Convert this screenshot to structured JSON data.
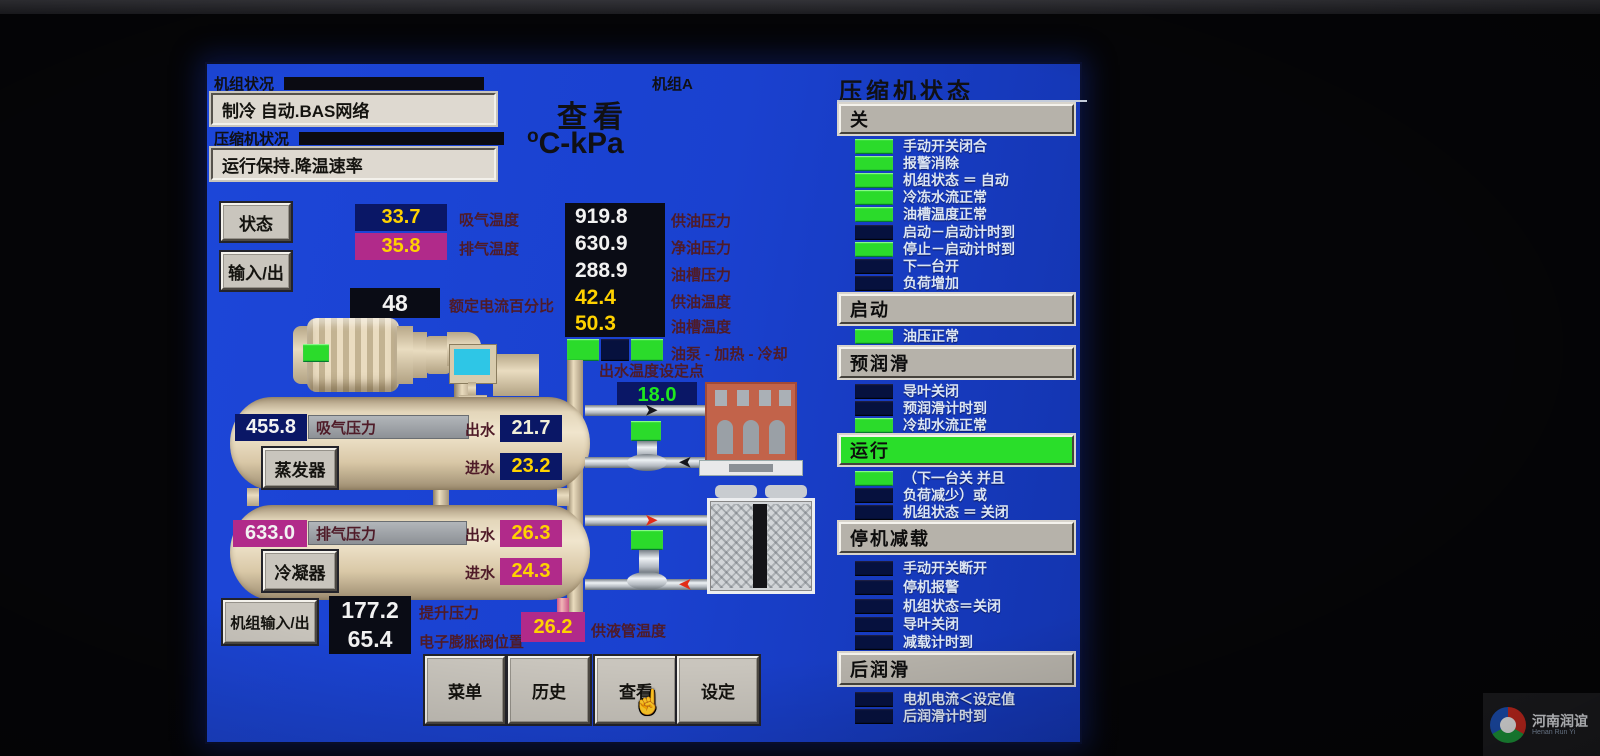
{
  "window": {
    "watermark_cn": "河南润谊",
    "watermark_en": "Henan Run Yi"
  },
  "colors": {
    "screen_blue": "#1a41cf",
    "navy_box": "#0a1766",
    "magenta_box": "#b12a8a",
    "value_yellow": "#ffd200",
    "green_indicator": "#2bdb2b",
    "dark_indicator": "#06113e",
    "setpoint_green": "#1ee81e"
  },
  "header": {
    "unit_status_label": "机组状况",
    "unit_name": "机组A",
    "unit_status_value": "制冷  自动.BAS网络",
    "comp_status_label": "压缩机状况",
    "comp_status_value": "运行保持.降温速率",
    "view_title": "查看",
    "units_sup": "o",
    "units_main": "C-kPa"
  },
  "side_buttons": {
    "status": "状态",
    "io": "输入/出",
    "unit_io": "机组输入/出"
  },
  "readings": {
    "suction_temp": {
      "value": "33.7",
      "label": "吸气温度"
    },
    "discharge_temp": {
      "value": "35.8",
      "label": "排气温度"
    },
    "current_pct": {
      "value": "48",
      "label": "额定电流百分比"
    },
    "oil_rows": [
      {
        "value": "919.8",
        "label": "供油压力"
      },
      {
        "value": "630.9",
        "label": "净油压力"
      },
      {
        "value": "288.9",
        "label": "油槽压力"
      },
      {
        "value": "42.4",
        "label": "供油温度"
      },
      {
        "value": "50.3",
        "label": "油槽温度"
      }
    ],
    "pump_heat_cool": {
      "label": "油泵 - 加热 - 冷却",
      "states": [
        "green",
        "dark",
        "green"
      ]
    },
    "setpoint": {
      "label": "出水温度设定点",
      "value": "18.0"
    },
    "lift_pressure": {
      "value": "177.2",
      "label": "提升压力"
    },
    "eev_position": {
      "value": "65.4",
      "label": "电子膨胀阀位置"
    },
    "liquid_line_temp": {
      "value": "26.2",
      "label": "供液管温度"
    }
  },
  "evaporator": {
    "button": "蒸发器",
    "pressure": {
      "value": "455.8",
      "label": "吸气压力"
    },
    "leaving": {
      "label": "出水",
      "value": "21.7"
    },
    "entering": {
      "label": "进水",
      "value": "23.2"
    }
  },
  "condenser": {
    "button": "冷凝器",
    "pressure": {
      "value": "633.0",
      "label": "排气压力"
    },
    "leaving": {
      "label": "出水",
      "value": "26.3"
    },
    "entering": {
      "label": "进水",
      "value": "24.3"
    }
  },
  "nav": {
    "menu": "菜单",
    "history": "历史",
    "view": "查看",
    "setting": "设定"
  },
  "right_panel": {
    "title": "压缩机状态",
    "sections": [
      {
        "header": "关",
        "style": "gray",
        "items": [
          {
            "label": "手动开关闭合",
            "state": "green"
          },
          {
            "label": "报警消除",
            "state": "green"
          },
          {
            "label": "机组状态 ＝ 自动",
            "state": "green"
          },
          {
            "label": "冷冻水流正常",
            "state": "green"
          },
          {
            "label": "油槽温度正常",
            "state": "green"
          },
          {
            "label": "启动－启动计时到",
            "state": "dark"
          },
          {
            "label": "停止－启动计时到",
            "state": "green"
          },
          {
            "label": "下一台开",
            "state": "dark"
          },
          {
            "label": "负荷增加",
            "state": "dark"
          }
        ]
      },
      {
        "header": "启动",
        "style": "gray",
        "items": [
          {
            "label": "油压正常",
            "state": "green"
          }
        ]
      },
      {
        "header": "预润滑",
        "style": "gray",
        "items": [
          {
            "label": "导叶关闭",
            "state": "dark"
          },
          {
            "label": "预润滑计时到",
            "state": "dark"
          },
          {
            "label": "冷却水流正常",
            "state": "green"
          }
        ]
      },
      {
        "header": "运行",
        "style": "green",
        "items": [
          {
            "label": "（下一台关 并且",
            "state": "green"
          },
          {
            "label": "负荷减少）或",
            "state": "dark"
          },
          {
            "label": "机组状态 ＝ 关闭",
            "state": "dark"
          }
        ]
      },
      {
        "header": "停机减载",
        "style": "gray",
        "items": [
          {
            "label": "手动开关断开",
            "state": "dark"
          },
          {
            "label": "停机报警",
            "state": "dark"
          },
          {
            "label": "机组状态＝关闭",
            "state": "dark"
          },
          {
            "label": "导叶关闭",
            "state": "dark"
          },
          {
            "label": "减载计时到",
            "state": "dark"
          }
        ]
      },
      {
        "header": "后润滑",
        "style": "gray",
        "items": [
          {
            "label": "电机电流＜设定值",
            "state": "dark"
          },
          {
            "label": "后润滑计时到",
            "state": "dark"
          }
        ]
      }
    ]
  }
}
